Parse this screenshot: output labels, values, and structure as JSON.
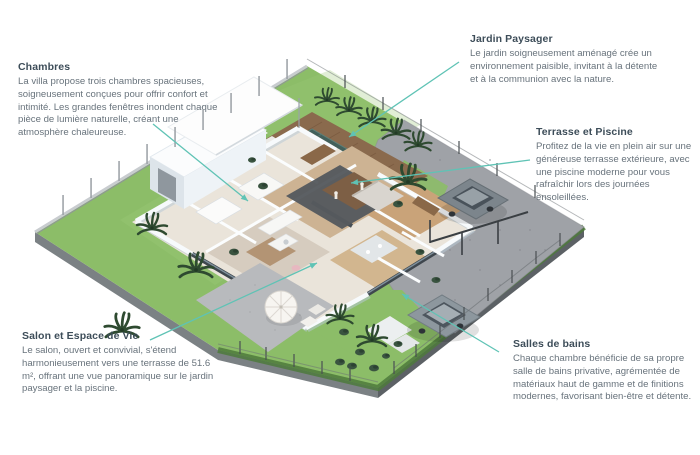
{
  "colors": {
    "accent_teal": "#5fc3b5",
    "heading_text": "#3d4d59",
    "body_text": "#68737c",
    "background": "#ffffff",
    "grass_green": "#8cbd68",
    "pool_teal": "#42605b",
    "deck_wood": "#8a6a4d",
    "gravel_gray": "#9fa2a7",
    "house_white": "#f7fafc"
  },
  "annotations": {
    "chambres": {
      "title": "Chambres",
      "body": "La villa propose trois chambres spacieuses, soigneusement conçues pour offrir confort et intimité. Les grandes fenêtres inondent chaque pièce de lumière naturelle, créant une atmosphère chaleureuse."
    },
    "jardin": {
      "title": "Jardin Paysager",
      "body": "Le jardin soigneusement aménagé crée un environnement paisible, invitant à la détente et à la communion avec la nature."
    },
    "terrasse": {
      "title": "Terrasse et Piscine",
      "body": "Profitez de la vie en plein air sur une généreuse terrasse extérieure, avec une piscine moderne pour vous rafraîchir lors des journées ensoleillées."
    },
    "salon": {
      "title": "Salon et Espace de Vie",
      "body": "Le salon, ouvert et convivial, s'étend harmonieusement vers une terrasse de 51.6 m², offrant une vue panoramique sur le jardin paysager et la piscine."
    },
    "salles_de_bains": {
      "title": "Salles de bains",
      "body": "Chaque chambre bénéficie de sa propre salle de bains privative, agrémentée de matériaux haut de gamme et de finitions modernes, favorisant bien-être et détente."
    }
  }
}
